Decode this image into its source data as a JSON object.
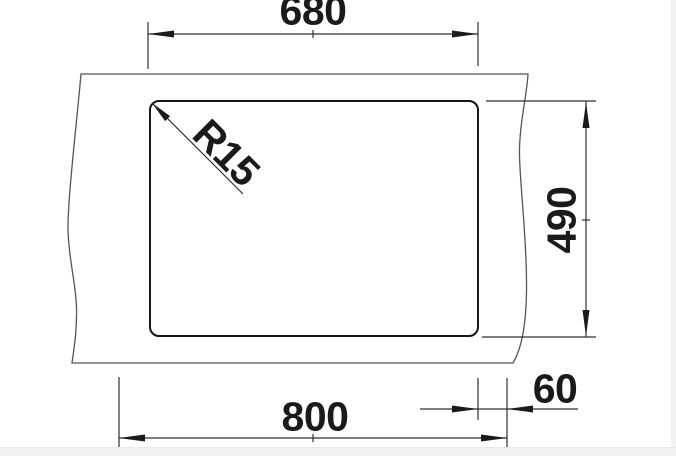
{
  "drawing": {
    "title": "sink-installation-dimension-drawing",
    "view": "top-view-cutout",
    "labels": {
      "top_width": "680",
      "depth": "490",
      "overall_width": "800",
      "side_offset": "60",
      "corner_radius": "R15"
    },
    "colors": {
      "background": "#ffffff",
      "page_margin": "#f1f1f2",
      "bowl_outline": "#161616",
      "counter_outline": "#555555",
      "dimension_lines": "#2f2f2f",
      "text": "#1a1a1a"
    }
  }
}
